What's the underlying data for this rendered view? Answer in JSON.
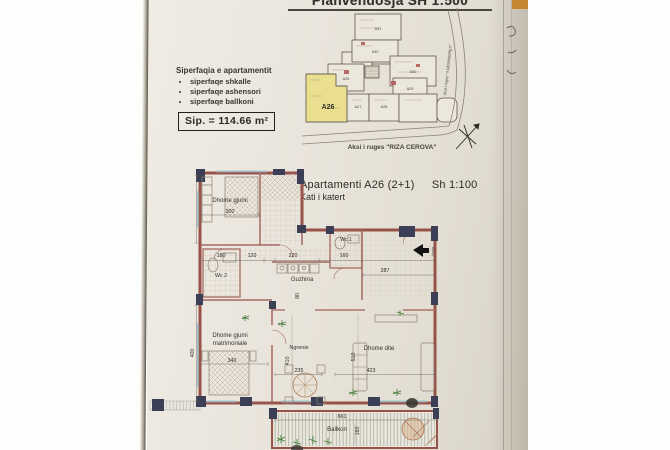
{
  "doc": {
    "title": "Planvendosja SH 1:500"
  },
  "site_plan": {
    "units": [
      {
        "label": "A31"
      },
      {
        "label": "A32"
      },
      {
        "label": "A30"
      },
      {
        "label": "A25"
      },
      {
        "label": "A29"
      },
      {
        "label": "A26"
      },
      {
        "label": "A27"
      },
      {
        "label": "A28"
      }
    ],
    "highlighted_unit": "A26",
    "street_side": "Aksi i ruges \"4 DESHMORET\"",
    "street_bottom": "Aksi i ruges \"RIZA CEROVA\""
  },
  "info_box": {
    "heading": "Siperfaqia e apartamentit",
    "bullets": [
      {
        "text": "siperfaqe shkalle"
      },
      {
        "text": "siperfaqe ashensori"
      },
      {
        "text": "siperfaqe ballkoni"
      }
    ],
    "area": "Sip. = 114.66 m²"
  },
  "plan_header": {
    "name": "Apartamenti  A26  (2+1)",
    "scale": "Sh 1:100",
    "floor": "Kati i katert"
  },
  "rooms": {
    "bedroom": "Dhome gjumi",
    "wc2": "Wc 2",
    "wc1": "Wc 1",
    "kitchen": "Guzhina",
    "master_line1": "Dhome gjumi",
    "master_line2": "matrimoniale",
    "dining": "Ngrenie",
    "living": "Dhome dite",
    "balcony": "Ballkon",
    "entry": "Hyrja"
  },
  "dims": {
    "bedroom_w": "300",
    "wc2_w": "180",
    "hall_w": "120",
    "kitchen_w": "220",
    "wc1_w": "160",
    "kitchen_d": "90",
    "entry_w": "287",
    "master_w": "340",
    "master_h": "400",
    "dining_w": "235",
    "dining_h": "410",
    "living_w": "423",
    "living_h": "510",
    "balcony_w": "661",
    "balcony_h": "160"
  },
  "colors": {
    "highlight_unit": "#e9df8e",
    "wall": "#97524a",
    "column": "#3a3f55",
    "plant": "#3f7a34",
    "tab": "#c6862f"
  }
}
